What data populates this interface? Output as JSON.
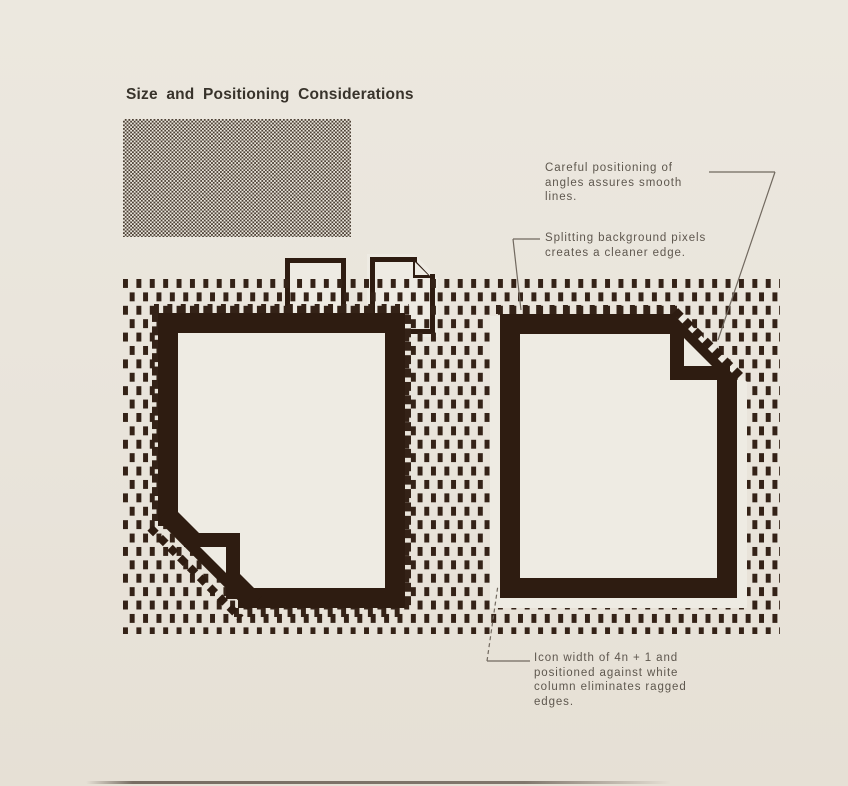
{
  "page": {
    "title": "Size and Positioning Considerations"
  },
  "annotations": {
    "smooth_lines": [
      "Careful positioning of",
      "angles assures smooth",
      "lines."
    ],
    "split_pixels": [
      "Splitting background pixels",
      "creates a cleaner edge."
    ],
    "icon_width": [
      "Icon width of 4n + 1 and",
      "positioned against white",
      "column eliminates ragged",
      "edges."
    ]
  },
  "icons": {
    "small_left": "document-icon-folded-corner-bottom-left",
    "small_right": "document-icon-folded-corner-top-right",
    "large_left": "magnified-document-icon-ragged-edges",
    "large_right": "magnified-document-icon-clean-edges"
  },
  "colors": {
    "paper": "#e9e4db",
    "icon_fill": "#eeebe3",
    "ink": "#2e1c11",
    "pattern_dash": "#342217",
    "title_text": "#38332b",
    "annotation_text": "#5e574e",
    "leader_line": "#71695f"
  }
}
